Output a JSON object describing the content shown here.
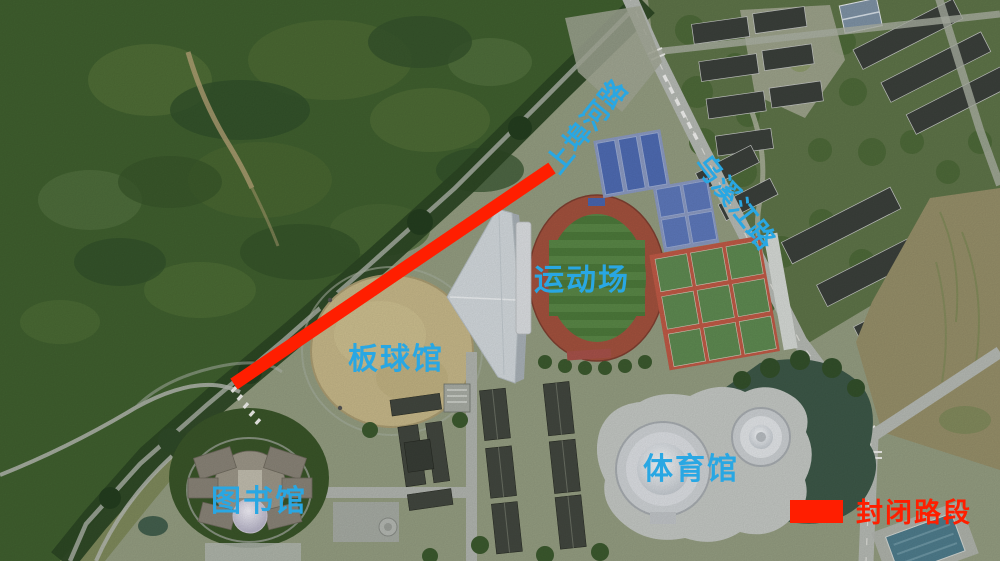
{
  "map": {
    "kind": "annotated-satellite-map",
    "labels": {
      "shangbuhe_road": "上埠河路",
      "wuxijiang_road": "乌溪江路",
      "sports_field": "运动场",
      "cricket_hall": "板球馆",
      "library": "图书馆",
      "gymnasium": "体育馆"
    },
    "legend": {
      "label": "封闭路段",
      "swatch_color": "#ff1e00"
    },
    "colors": {
      "annotation_blue": "#29a7e3",
      "closed_road_red": "#ff1e00"
    }
  }
}
